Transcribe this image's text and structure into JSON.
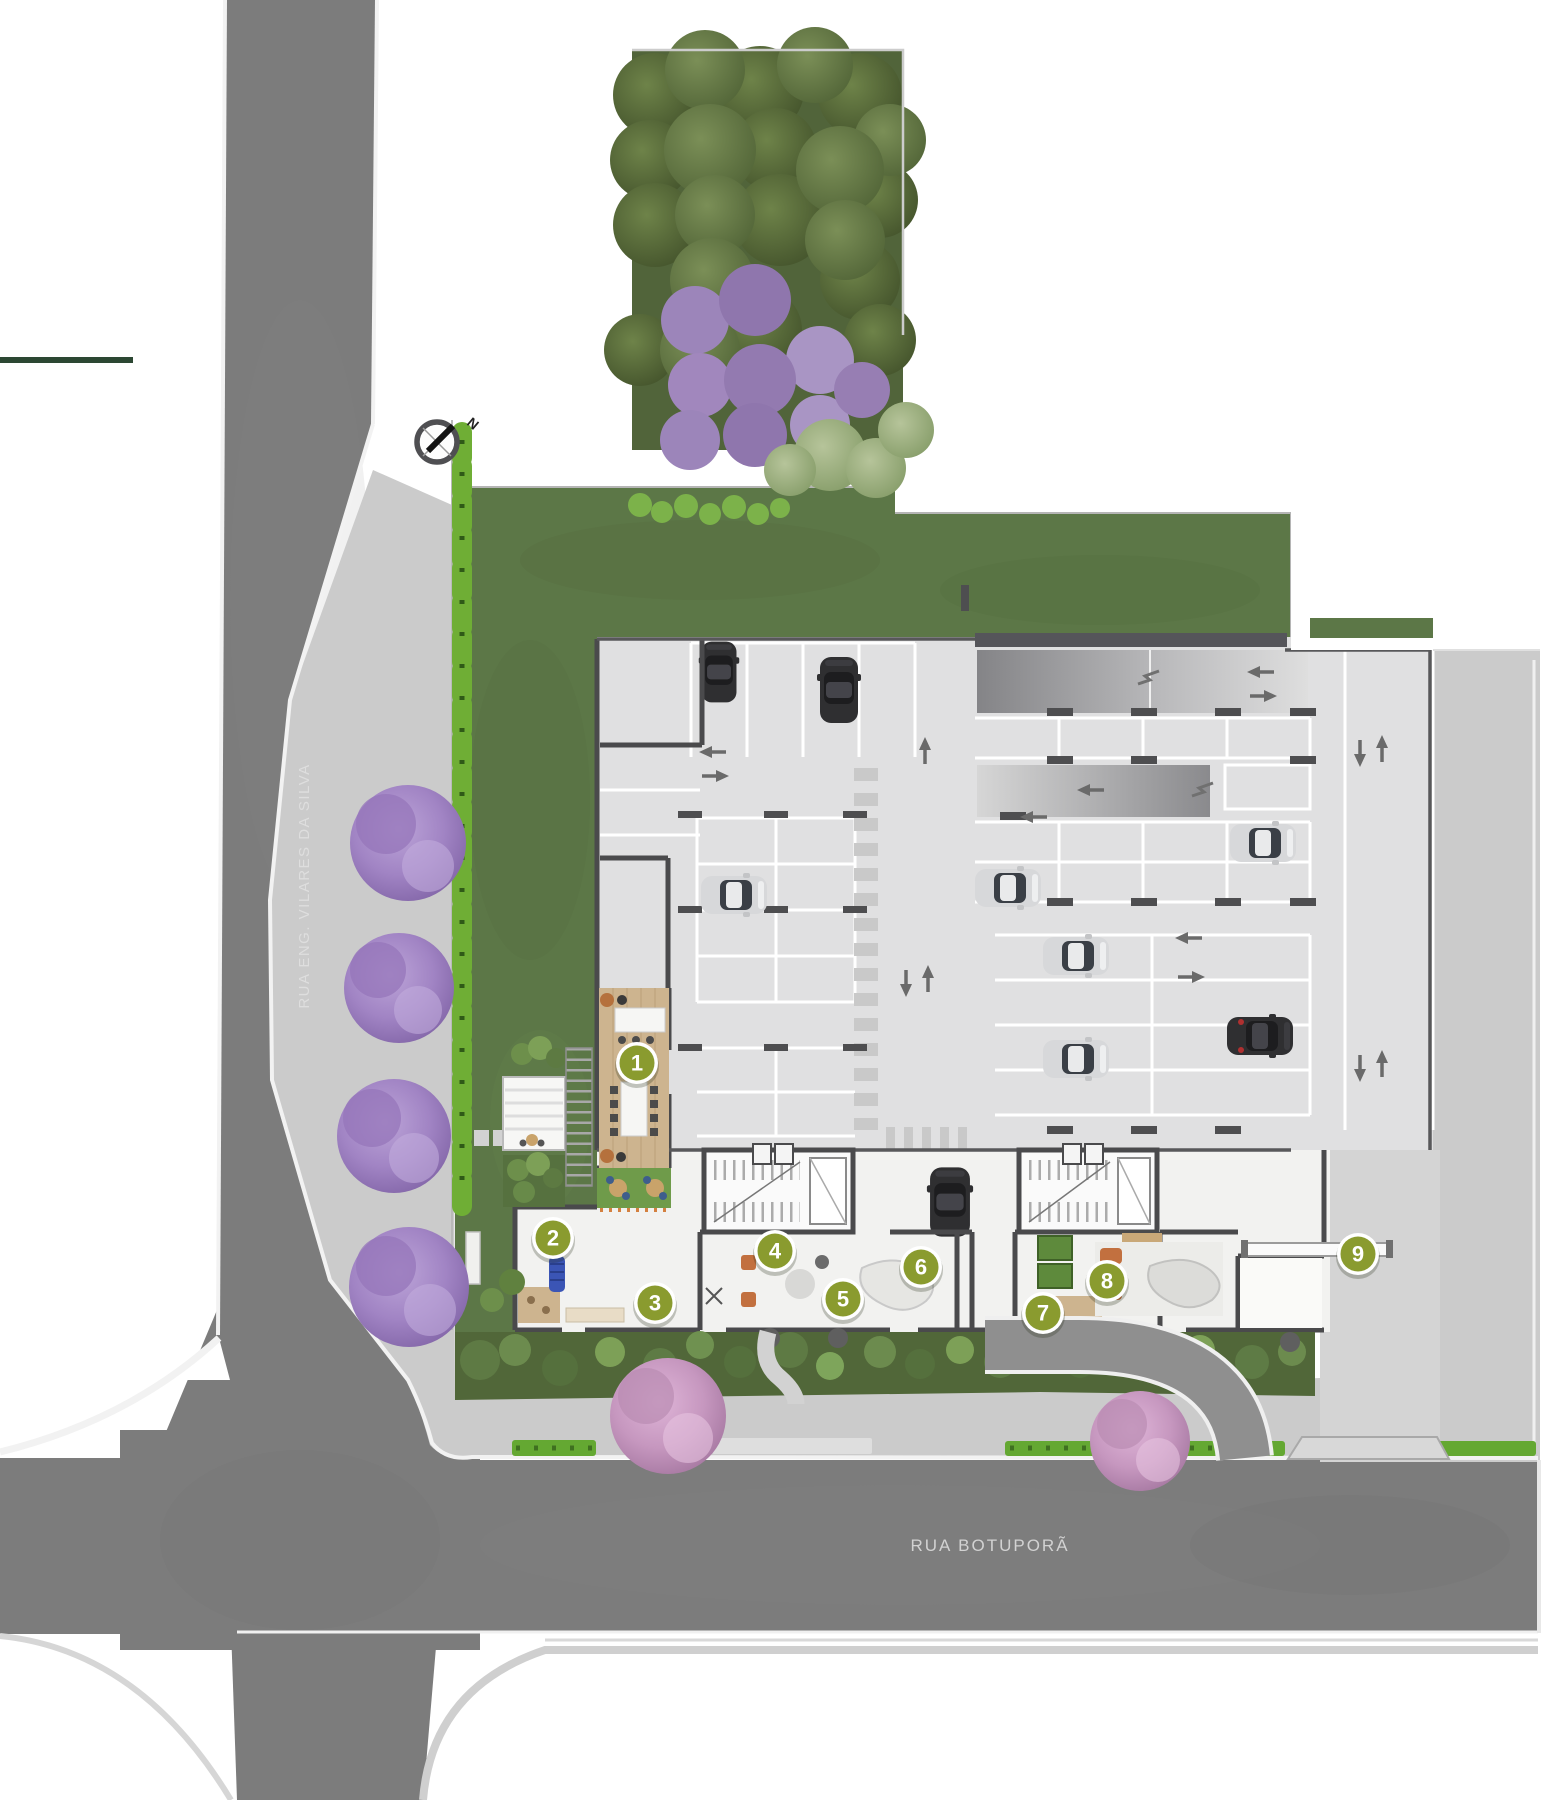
{
  "plan": {
    "compass": {
      "label": "N"
    },
    "streets": {
      "left": {
        "name": "RUA ENG. VILARES DA SILVA"
      },
      "bottom": {
        "name": "RUA BOTUPORÃ"
      }
    },
    "markers": [
      {
        "label": "1"
      },
      {
        "label": "2"
      },
      {
        "label": "3"
      },
      {
        "label": "4"
      },
      {
        "label": "5"
      },
      {
        "label": "6"
      },
      {
        "label": "7"
      },
      {
        "label": "8"
      },
      {
        "label": "9"
      }
    ],
    "colors": {
      "lawn": "#5c7747",
      "road": "#7c7c7c",
      "sidewalk": "#cbcbcb",
      "building_floor": "#e0e0e1",
      "wall": "#4a4a4c",
      "marker_fill": "#8a9b2f",
      "accent_line": "#2c4733",
      "hedge": "#6fae35",
      "purple_tree": "#a98fc9",
      "pink_tree": "#cf9fc9",
      "wood_floor": "#cdb48f"
    }
  }
}
